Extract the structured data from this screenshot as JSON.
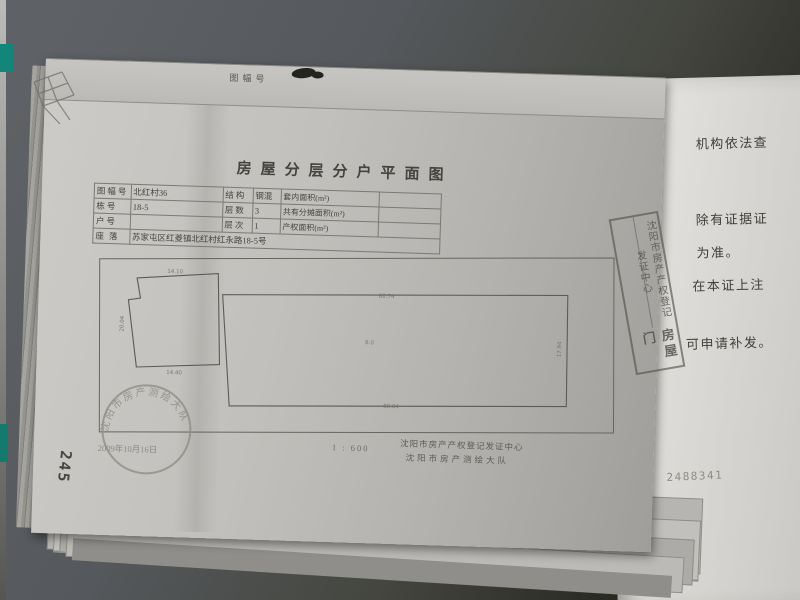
{
  "document": {
    "edge_label": "图幅号",
    "title": "房屋分层分户平面图",
    "table": {
      "rows": [
        {
          "l1": "图幅号",
          "v1": "北红村36",
          "l2": "结构",
          "v2": "钢混",
          "l3": "套内面积(m²)",
          "v3": ""
        },
        {
          "l1": "栋号",
          "v1": "18-5",
          "l2": "层数",
          "v2": "3",
          "l3": "共有分摊面积(m²)",
          "v3": ""
        },
        {
          "l1": "户号",
          "v1": "",
          "l2": "层次",
          "v2": "1",
          "l3": "产权面积(m²)",
          "v3": ""
        }
      ],
      "address_label": "座落",
      "address_value": "苏家屯区红菱镇北红村红永路18-5号"
    },
    "plan": {
      "left_unit": {
        "top": "14.10",
        "bottom": "14.40",
        "left": "20.04"
      },
      "right_unit": {
        "top": "80.74",
        "bottom": "80.04",
        "inner": "6.0",
        "right": "17.94"
      }
    },
    "footer": {
      "date": "2009年10月16日",
      "scale": "1 : 600",
      "org1": "沈阳市房产产权登记发证中心",
      "org2": "沈阳市房产测绘大队"
    },
    "round_stamp_text": "沈阳市房产测绘大队",
    "page_number": "245"
  },
  "diagonal_stamp": {
    "line1": "沈阳市房产产权登记发证中心",
    "line2": "房屋门"
  },
  "next_page": {
    "fragments": [
      "机构依法查",
      "除有证据证",
      "为准。",
      "在本证上注",
      "可申请补发。"
    ],
    "serial": "2488341"
  }
}
